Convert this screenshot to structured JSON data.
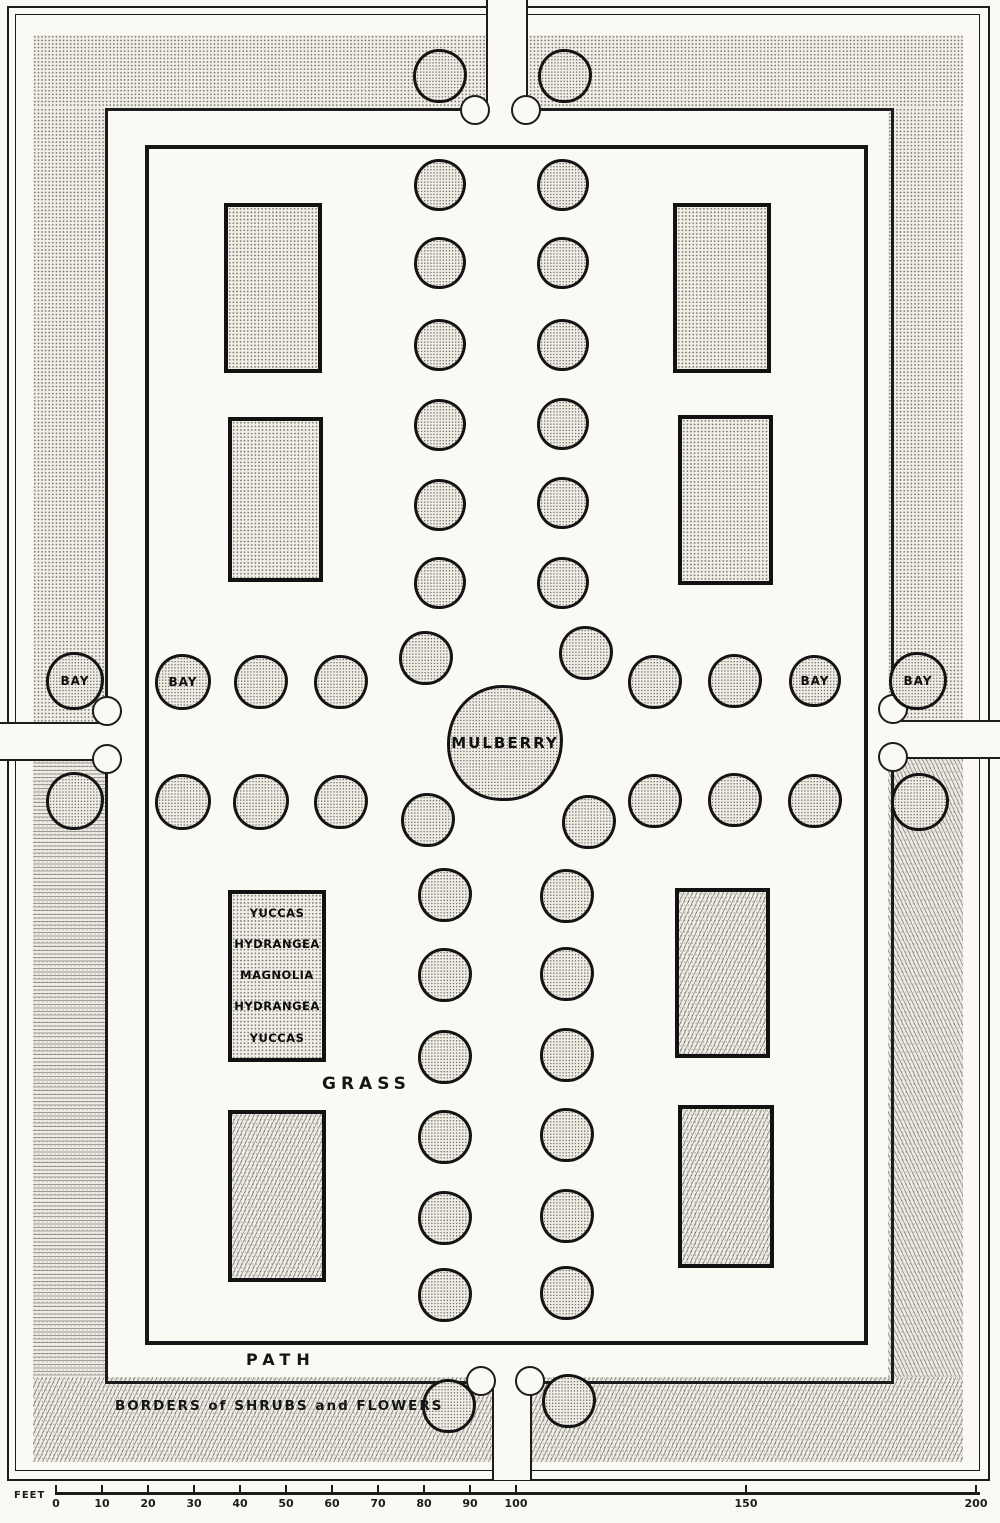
{
  "figure": {
    "type": "formal-garden-plan",
    "labels": {
      "mulberry": "MULBERRY",
      "bay": "BAY",
      "grass": "GRASS",
      "path": "PATH",
      "borders": "BORDERS of SHRUBS and FLOWERS",
      "feet": "FEET"
    },
    "bed_labels": [
      "YUCCAS",
      "HYDRANGEA",
      "MAGNOLIA",
      "HYDRANGEA",
      "YUCCAS"
    ],
    "scale": {
      "unit": "FEET",
      "ticks": [
        0,
        10,
        20,
        30,
        40,
        50,
        60,
        70,
        80,
        90,
        100,
        150,
        200
      ]
    },
    "trees": [
      {
        "x": 440,
        "y": 76,
        "r": 27
      },
      {
        "x": 565,
        "y": 76,
        "r": 27
      },
      {
        "x": 449,
        "y": 1406,
        "r": 27
      },
      {
        "x": 569,
        "y": 1401,
        "r": 27
      },
      {
        "x": 75,
        "y": 681,
        "r": 29,
        "label": "BAY"
      },
      {
        "x": 75,
        "y": 801,
        "r": 29
      },
      {
        "x": 918,
        "y": 681,
        "r": 29,
        "label": "BAY"
      },
      {
        "x": 920,
        "y": 802,
        "r": 29
      },
      {
        "x": 440,
        "y": 185,
        "r": 26
      },
      {
        "x": 440,
        "y": 263,
        "r": 26
      },
      {
        "x": 440,
        "y": 345,
        "r": 26
      },
      {
        "x": 440,
        "y": 425,
        "r": 26
      },
      {
        "x": 440,
        "y": 505,
        "r": 26
      },
      {
        "x": 440,
        "y": 583,
        "r": 26
      },
      {
        "x": 563,
        "y": 185,
        "r": 26
      },
      {
        "x": 563,
        "y": 263,
        "r": 26
      },
      {
        "x": 563,
        "y": 345,
        "r": 26
      },
      {
        "x": 563,
        "y": 424,
        "r": 26
      },
      {
        "x": 563,
        "y": 503,
        "r": 26
      },
      {
        "x": 563,
        "y": 583,
        "r": 26
      },
      {
        "x": 183,
        "y": 682,
        "r": 28,
        "label": "BAY"
      },
      {
        "x": 261,
        "y": 682,
        "r": 27
      },
      {
        "x": 341,
        "y": 682,
        "r": 27
      },
      {
        "x": 426,
        "y": 658,
        "r": 27
      },
      {
        "x": 586,
        "y": 653,
        "r": 27
      },
      {
        "x": 655,
        "y": 682,
        "r": 27
      },
      {
        "x": 735,
        "y": 681,
        "r": 27
      },
      {
        "x": 815,
        "y": 681,
        "r": 26,
        "label": "BAY"
      },
      {
        "x": 505,
        "y": 743,
        "r": 58,
        "label": "MULBERRY"
      },
      {
        "x": 183,
        "y": 802,
        "r": 28
      },
      {
        "x": 261,
        "y": 802,
        "r": 28
      },
      {
        "x": 341,
        "y": 802,
        "r": 27
      },
      {
        "x": 428,
        "y": 820,
        "r": 27
      },
      {
        "x": 589,
        "y": 822,
        "r": 27
      },
      {
        "x": 655,
        "y": 801,
        "r": 27
      },
      {
        "x": 735,
        "y": 800,
        "r": 27
      },
      {
        "x": 815,
        "y": 801,
        "r": 27
      },
      {
        "x": 445,
        "y": 895,
        "r": 27
      },
      {
        "x": 445,
        "y": 975,
        "r": 27
      },
      {
        "x": 445,
        "y": 1057,
        "r": 27
      },
      {
        "x": 445,
        "y": 1137,
        "r": 27
      },
      {
        "x": 445,
        "y": 1218,
        "r": 27
      },
      {
        "x": 445,
        "y": 1295,
        "r": 27
      },
      {
        "x": 567,
        "y": 896,
        "r": 27
      },
      {
        "x": 567,
        "y": 974,
        "r": 27
      },
      {
        "x": 567,
        "y": 1055,
        "r": 27
      },
      {
        "x": 567,
        "y": 1135,
        "r": 27
      },
      {
        "x": 567,
        "y": 1216,
        "r": 27
      },
      {
        "x": 567,
        "y": 1293,
        "r": 27
      }
    ],
    "beds": [
      {
        "x": 224,
        "y": 203,
        "w": 98,
        "h": 170,
        "texture": "dots"
      },
      {
        "x": 228,
        "y": 417,
        "w": 95,
        "h": 165,
        "texture": "dots"
      },
      {
        "x": 673,
        "y": 203,
        "w": 98,
        "h": 170,
        "texture": "dots"
      },
      {
        "x": 678,
        "y": 415,
        "w": 95,
        "h": 170,
        "texture": "dots"
      },
      {
        "x": 228,
        "y": 890,
        "w": 98,
        "h": 172,
        "texture": "dots",
        "labeled": true
      },
      {
        "x": 675,
        "y": 888,
        "w": 95,
        "h": 170,
        "texture": "diag"
      },
      {
        "x": 228,
        "y": 1110,
        "w": 98,
        "h": 172,
        "texture": "diag"
      },
      {
        "x": 678,
        "y": 1105,
        "w": 96,
        "h": 163,
        "texture": "diag"
      }
    ]
  }
}
